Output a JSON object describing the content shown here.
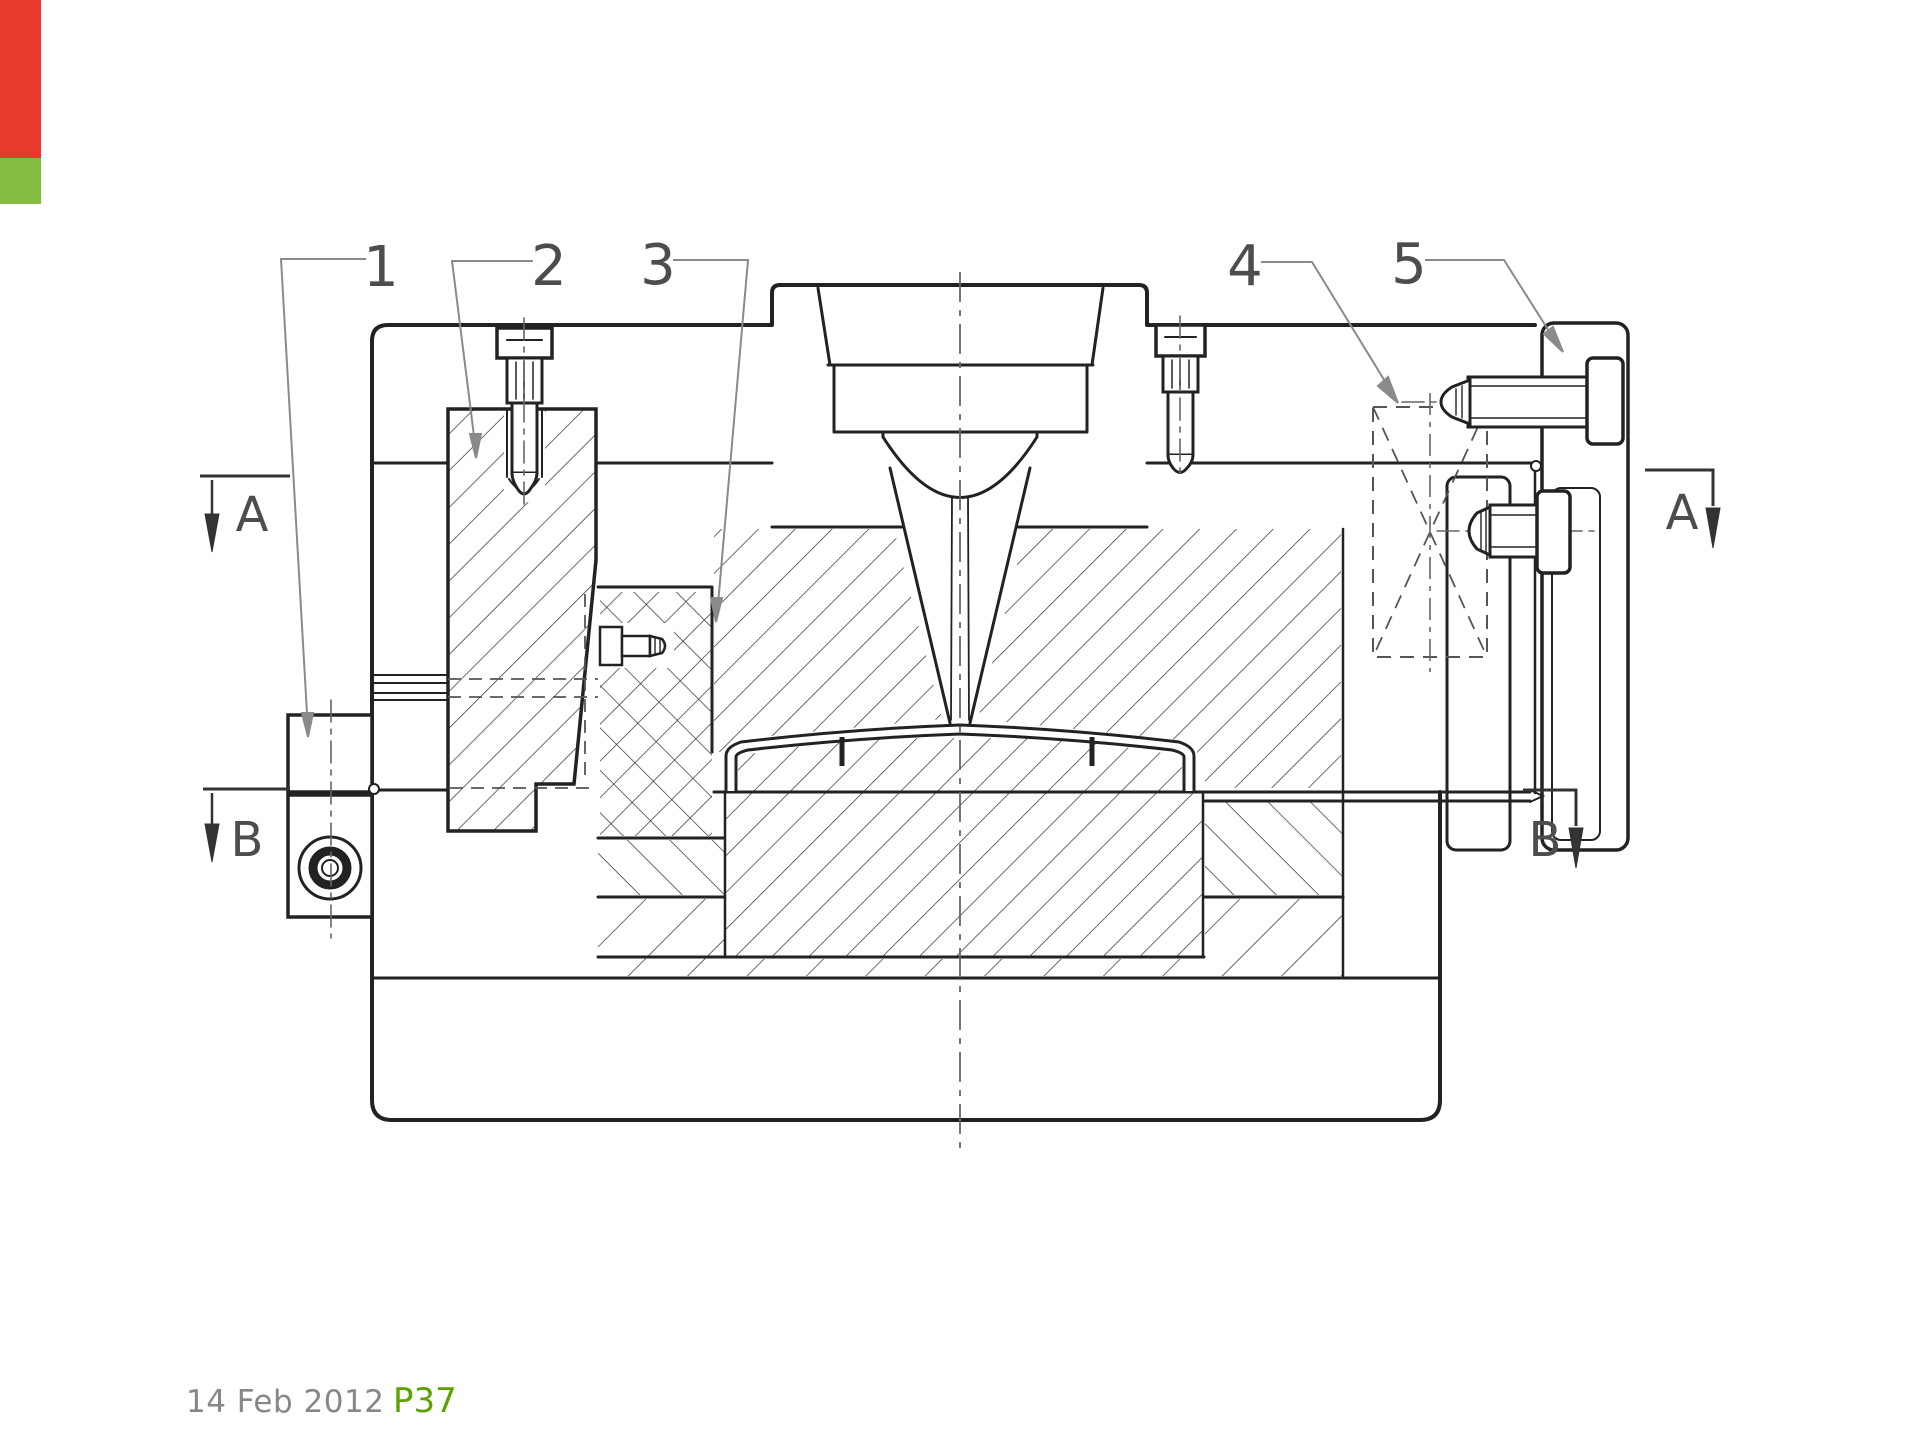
{
  "edge_bars": {
    "red_color": "#e8392e",
    "green_color": "#84bd41"
  },
  "footer": {
    "date": "14 Feb 2012",
    "page_ref": "P37",
    "date_color": "#85878a",
    "page_ref_color": "#5ba300"
  },
  "drawing": {
    "type": "engineering-section-view",
    "subject": "injection mould tool cross-section",
    "balloons": [
      "1",
      "2",
      "3",
      "4",
      "5"
    ],
    "section_markers": {
      "a_left": "A",
      "a_right": "A",
      "b_left": "B",
      "b_right": "B"
    },
    "line_color": "#222222",
    "hatch_color": "#3c3c3c",
    "label_color": "#4d4d4d",
    "leader_color": "#8a8a8a"
  }
}
